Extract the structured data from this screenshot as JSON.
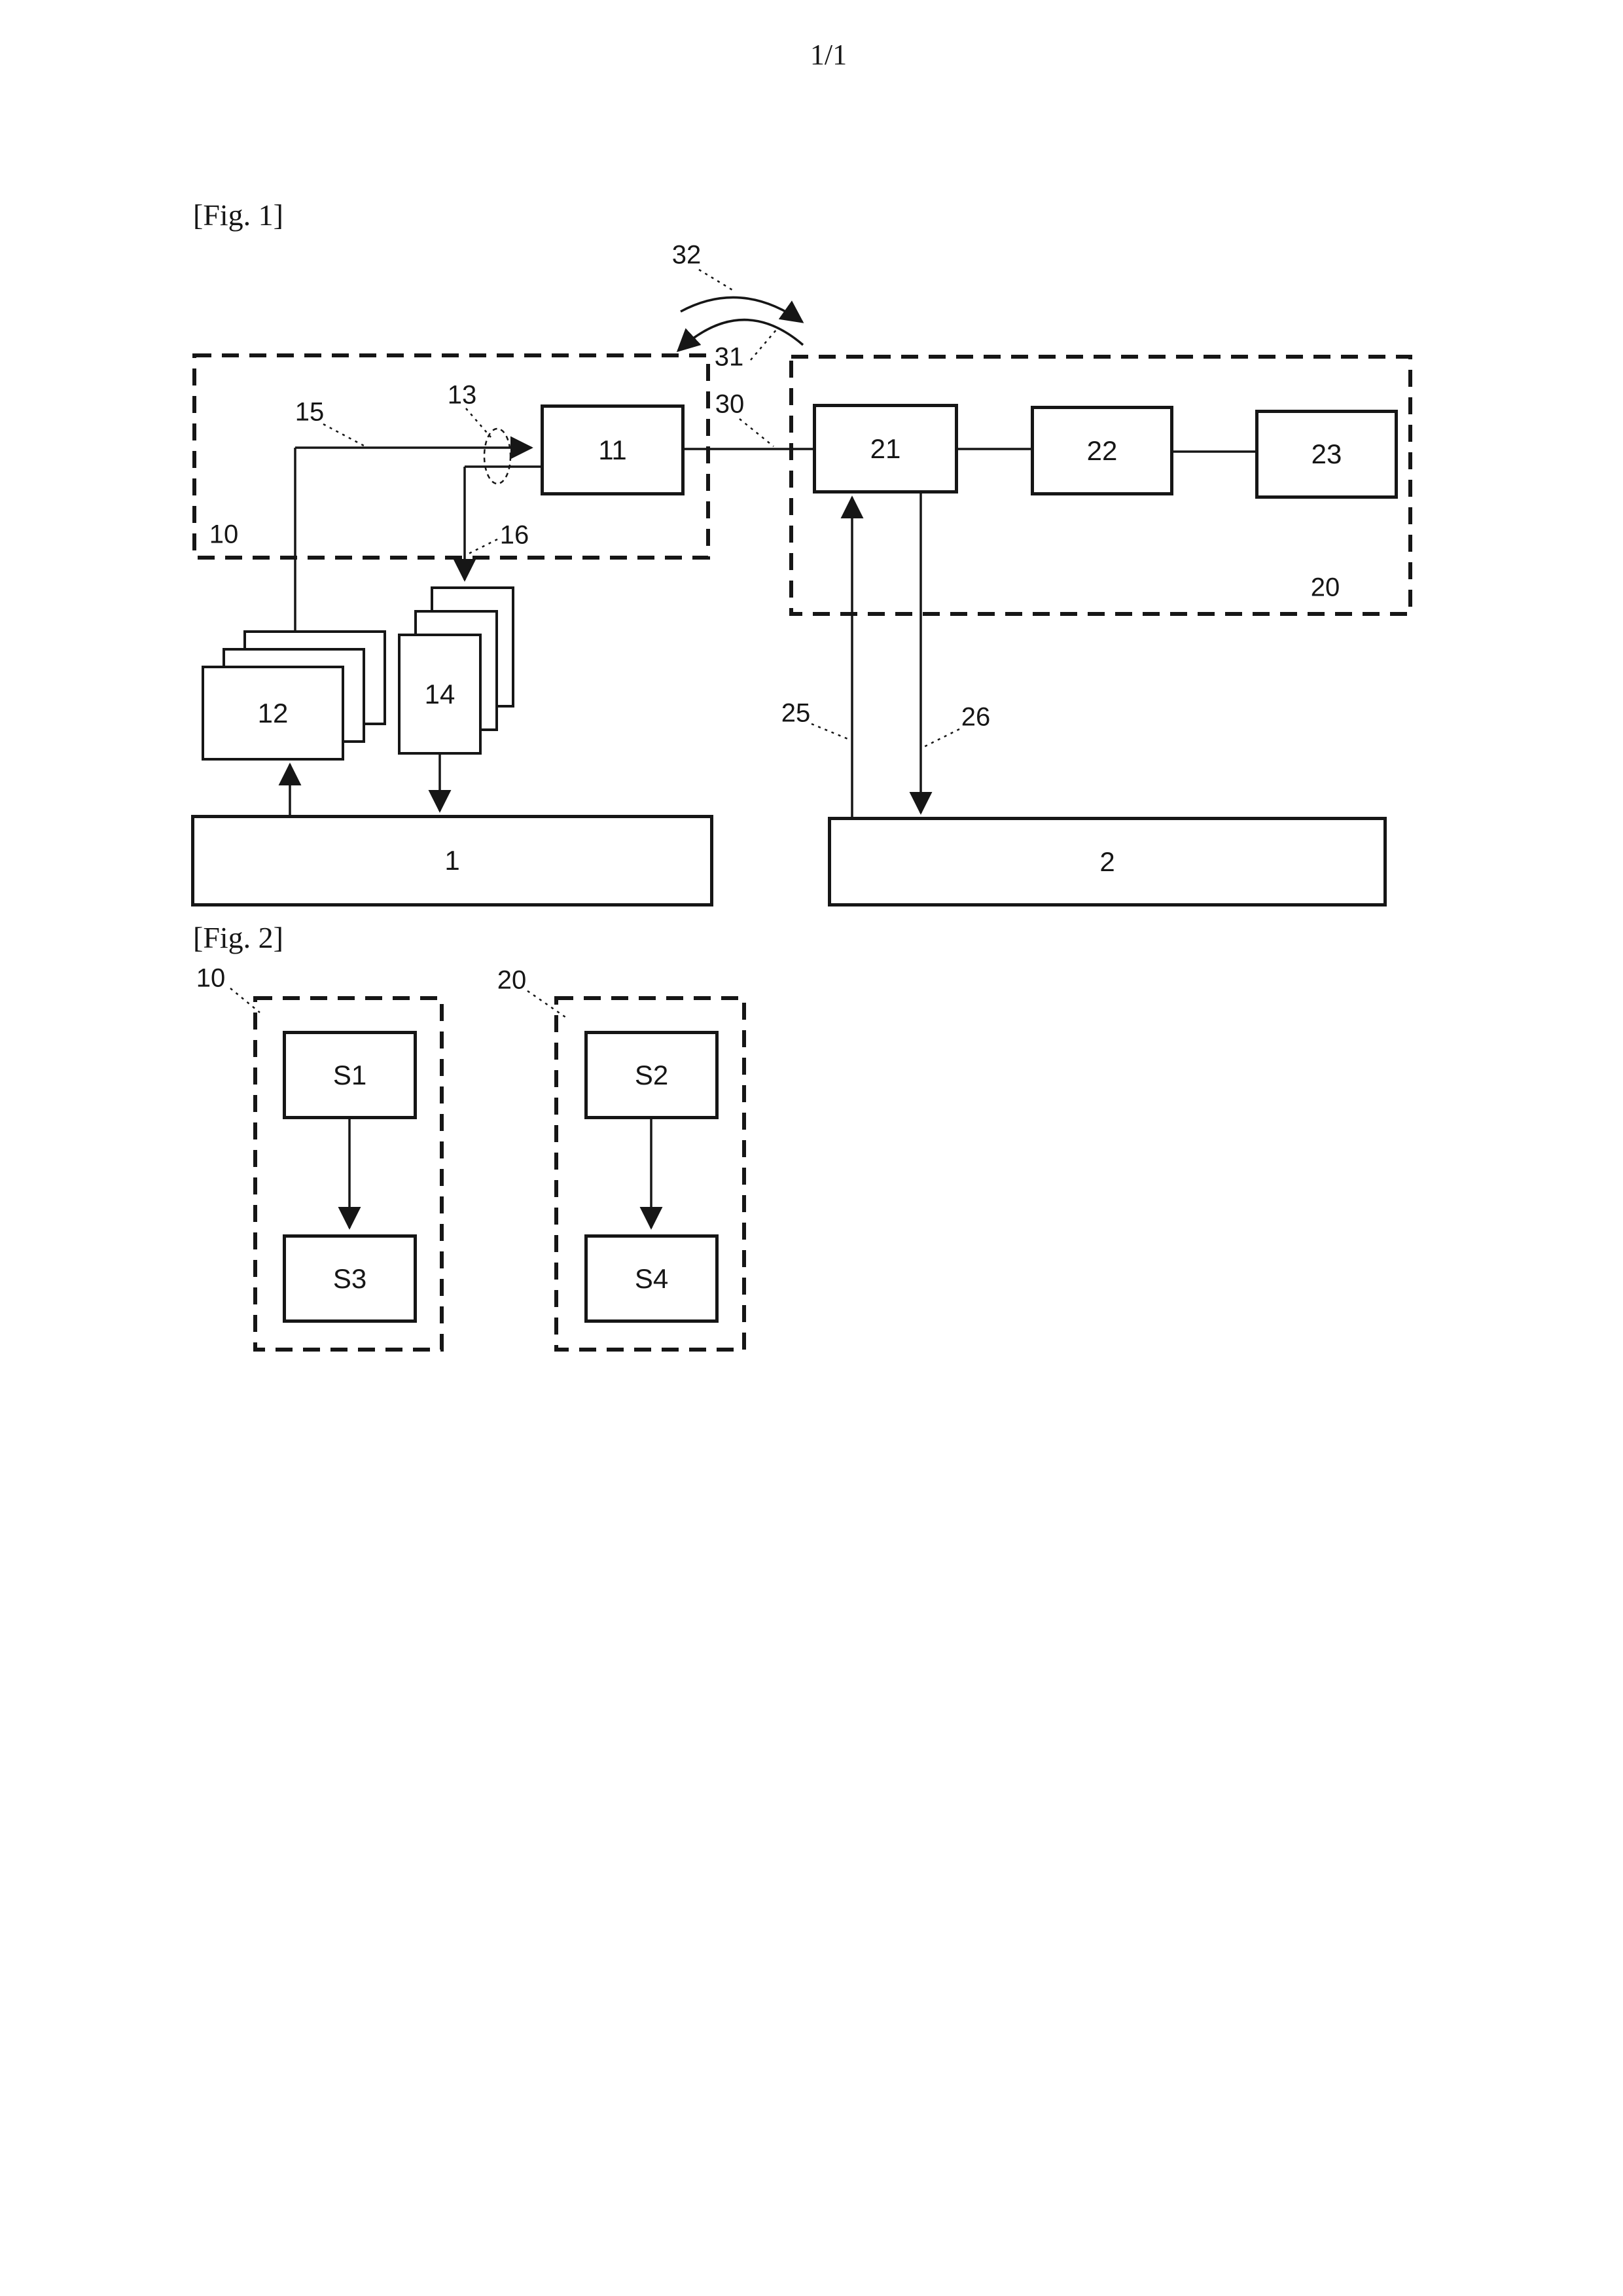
{
  "colors": {
    "ink": "#161616",
    "paper": "#ffffff"
  },
  "page": {
    "number": "1/1"
  },
  "figure1": {
    "caption": "[Fig. 1]",
    "boxes": {
      "b11": "11",
      "b21": "21",
      "b22": "22",
      "b23": "23",
      "b1": "1",
      "b2": "2"
    },
    "stacks": {
      "s12": "12",
      "s14": "14"
    },
    "refs": {
      "r10": "10",
      "r13": "13",
      "r15": "15",
      "r16": "16",
      "r20": "20",
      "r25": "25",
      "r26": "26",
      "r30": "30",
      "r31": "31",
      "r32": "32"
    }
  },
  "figure2": {
    "caption": "[Fig. 2]",
    "refs": {
      "r10": "10",
      "r20": "20"
    },
    "boxes": {
      "s1": "S1",
      "s2": "S2",
      "s3": "S3",
      "s4": "S4"
    }
  }
}
